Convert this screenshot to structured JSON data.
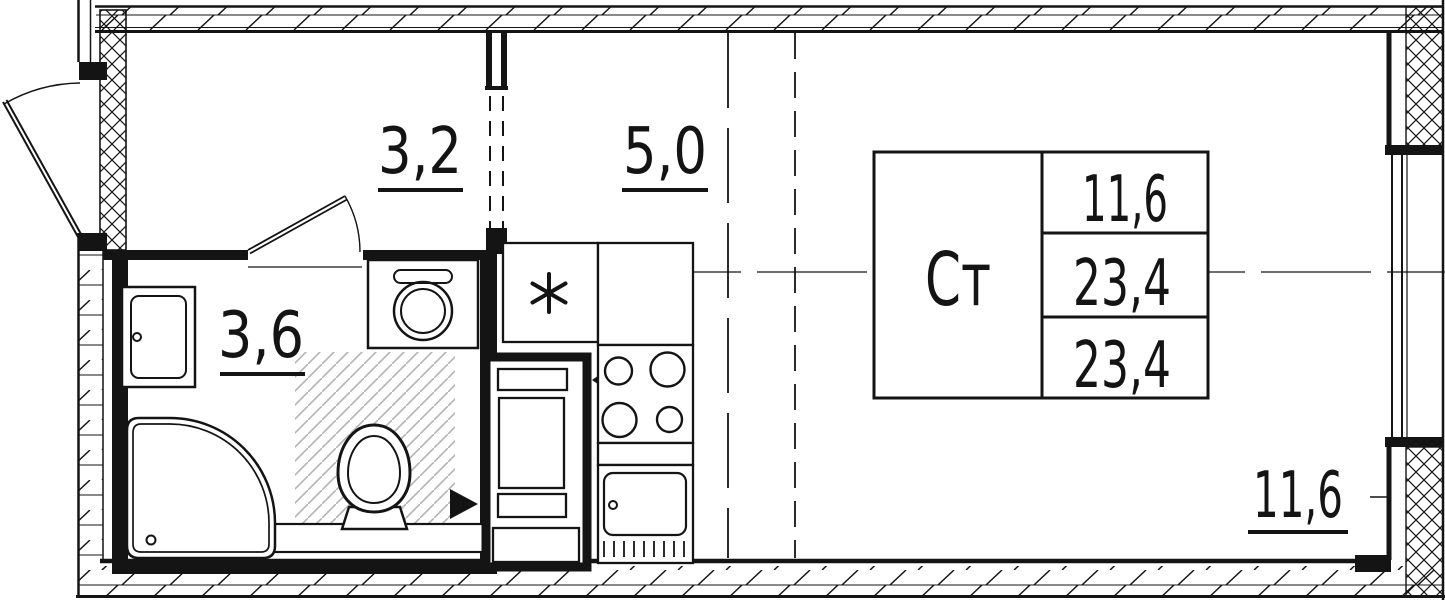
{
  "plan_type": "studio-apartment-floor-plan",
  "rooms": {
    "hallway": {
      "area_label": "3,2"
    },
    "kitchen": {
      "area_label": "5,0"
    },
    "bathroom": {
      "area_label": "3,6"
    },
    "living": {
      "area_label": "11,6"
    }
  },
  "summary_table": {
    "room_type_abbr": "Ст",
    "values": [
      "11,6",
      "23,4",
      "23,4"
    ]
  },
  "symbols": {
    "kitchen_sink_marker": "six-point-asterisk",
    "vent_arrows": "solid-black-triangles-pointing-at-duct"
  },
  "colors": {
    "line": "#141414",
    "background": "#ffffff",
    "platform_hatch": "#b3b3b3"
  }
}
